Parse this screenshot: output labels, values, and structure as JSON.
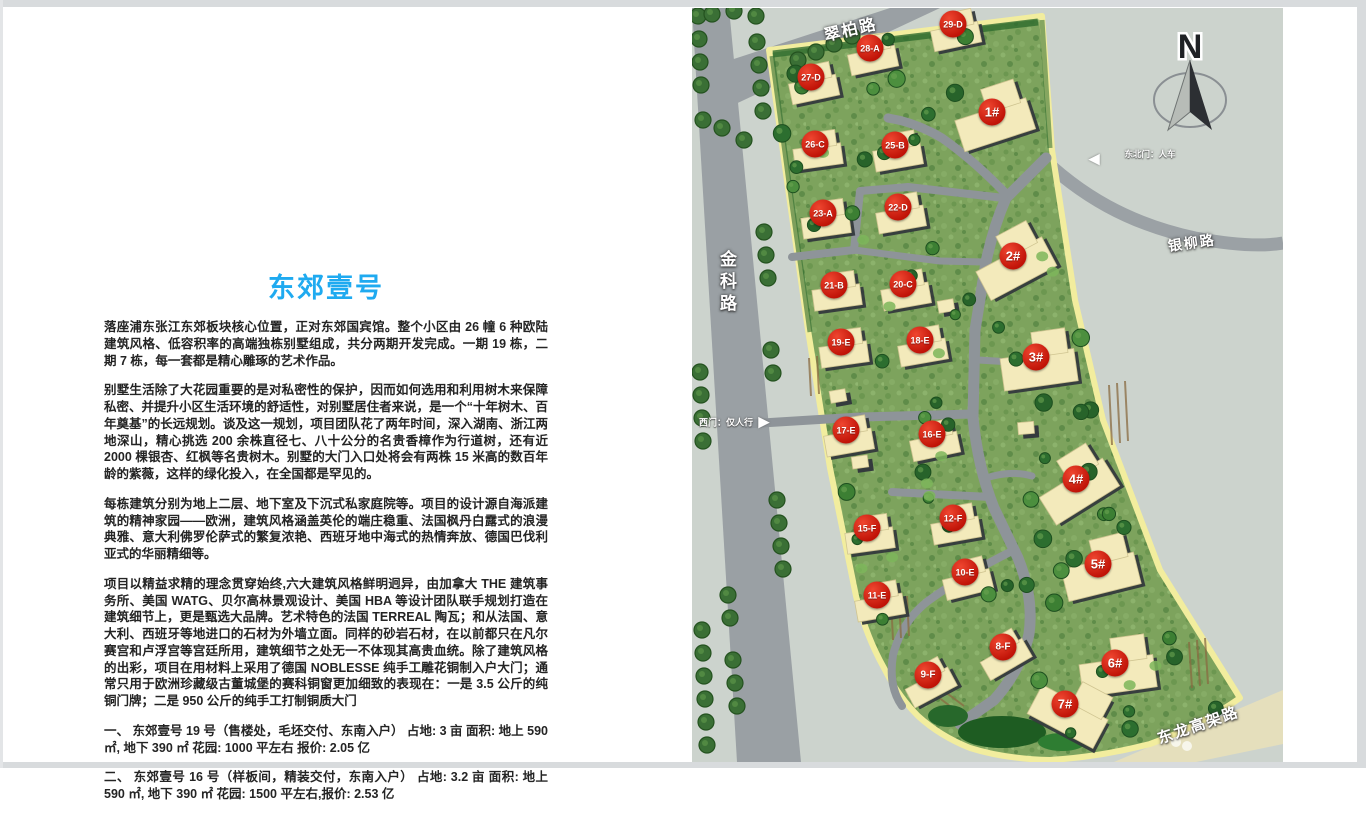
{
  "doc": {
    "title": "东郊壹号",
    "title_color": "#1faaf0",
    "paragraphs": [
      "落座浦东张江东郊板块核心位置，正对东郊国宾馆。整个小区由 26 幢 6 种欧陆建筑风格、低容积率的高端独栋别墅组成，共分两期开发完成。一期 19 栋，二期 7 栋，每一套都是精心雕琢的艺术作品。",
      "别墅生活除了大花园重要的是对私密性的保护，因而如何选用和利用树木来保障私密、并提升小区生活环境的舒适性，对别墅居住者来说，是一个“十年树木、百年奠基”的长远规划。谈及这一规划，项目团队花了两年时间，深入湖南、浙江两地深山，精心挑选 200 余株直径七、八十公分的名贵香樟作为行道树，还有近 2000 棵银杏、红枫等名贵树木。别墅的大门入口处将会有两株 15 米高的数百年龄的紫薇，这样的绿化投入，在全国都是罕见的。",
      "每栋建筑分别为地上二层、地下室及下沉式私家庭院等。项目的设计源自海派建筑的精神家园——欧洲，建筑风格涵盖英伦的端庄稳重、法国枫丹白露式的浪漫典雅、意大利佛罗伦萨式的繁复浓艳、西班牙地中海式的热情奔放、德国巴伐利亚式的华丽精细等。",
      "项目以精益求精的理念贯穿始终,六大建筑风格鲜明迥异，由加拿大 THE 建筑事务所、美国 WATG、贝尔高林景观设计、美国 HBA 等设计团队联手规划打造在建筑细节上，更是甄选大品牌。艺术特色的法国 TERREAL 陶瓦；和从法国、意大利、西班牙等地进口的石材为外墙立面。同样的砂岩石材，在以前都只在凡尔赛宫和卢浮宫等宫廷所用，建筑细节之处无一不体现其高贵血统。除了建筑风格的出彩，项目在用材料上采用了德国 NOBLESSE 纯手工雕花铜制入户大门；通常只用于欧洲珍藏级古董城堡的赛科铜窗更加细致的表现在：一是 3.5 公斤的纯铜门牌；二是 950 公斤的纯手工打制铜质大门"
    ],
    "items": [
      "一、 东郊壹号 19 号（售楼处，毛坯交付、东南入户） 占地: 3 亩 面积: 地上 590 ㎡, 地下 390 ㎡ 花园: 1000 平左右 报价: 2.05 亿",
      "二、 东郊壹号 16 号（样板间，精装交付，东南入户） 占地: 3.2 亩 面积: 地上 590 ㎡, 地下 390 ㎡ 花园: 1500 平左右,报价: 2.53 亿"
    ]
  },
  "map": {
    "compass": "N",
    "marker_color": "#c8170b",
    "parcel_border_color": "#f2ed9e",
    "roads": [
      {
        "name": "cuibai-road",
        "label": "翠柏路",
        "x": 824,
        "y": 22,
        "rot": -13,
        "size": 16
      },
      {
        "name": "jinke-road",
        "label": "金科路",
        "x": 714,
        "y": 250,
        "rot": 0,
        "size": 17,
        "vertical": true
      },
      {
        "name": "yinliu-road",
        "label": "银柳路",
        "x": 1168,
        "y": 236,
        "rot": -8,
        "size": 14
      },
      {
        "name": "donglong-road",
        "label": "东龙高架路",
        "x": 1158,
        "y": 728,
        "rot": -19,
        "size": 15
      }
    ],
    "gates": [
      {
        "name": "northeast-gate",
        "label": "东北门：人车",
        "tx": 1150,
        "ty": 154,
        "arrow": "◀",
        "ax": 1094,
        "ay": 159,
        "fs": 8.5,
        "as": 15
      },
      {
        "name": "west-gate",
        "label": "西门：仅人行",
        "tx": 726,
        "ty": 422,
        "arrow": "▶",
        "ax": 764,
        "ay": 422,
        "fs": 9,
        "as": 15
      }
    ],
    "markers": [
      {
        "label": "1#",
        "x": 992,
        "y": 112,
        "big": 1,
        "rot": -18
      },
      {
        "label": "2#",
        "x": 1013,
        "y": 256,
        "big": 1,
        "rot": -28
      },
      {
        "label": "3#",
        "x": 1036,
        "y": 357,
        "big": 1,
        "rot": -8
      },
      {
        "label": "4#",
        "x": 1076,
        "y": 479,
        "big": 1,
        "rot": -32
      },
      {
        "label": "5#",
        "x": 1098,
        "y": 564,
        "big": 1,
        "rot": -14
      },
      {
        "label": "6#",
        "x": 1115,
        "y": 663,
        "big": 1,
        "rot": -8
      },
      {
        "label": "7#",
        "x": 1065,
        "y": 704,
        "big": 1,
        "rot": 28
      },
      {
        "label": "8-F",
        "x": 1003,
        "y": 647,
        "rot": -30
      },
      {
        "label": "9-F",
        "x": 928,
        "y": 675,
        "rot": -28
      },
      {
        "label": "10-E",
        "x": 965,
        "y": 572,
        "rot": -14
      },
      {
        "label": "11-E",
        "x": 877,
        "y": 595,
        "rot": -10
      },
      {
        "label": "12-F",
        "x": 953,
        "y": 518,
        "rot": -10
      },
      {
        "label": "15-F",
        "x": 867,
        "y": 528,
        "rot": -8
      },
      {
        "label": "16-E",
        "x": 932,
        "y": 434,
        "rot": -12
      },
      {
        "label": "17-E",
        "x": 846,
        "y": 430,
        "rot": -10
      },
      {
        "label": "18-E",
        "x": 920,
        "y": 340,
        "rot": -10
      },
      {
        "label": "19-E",
        "x": 841,
        "y": 342,
        "rot": -8
      },
      {
        "label": "20-C",
        "x": 903,
        "y": 284,
        "rot": -10
      },
      {
        "label": "21-B",
        "x": 834,
        "y": 285,
        "rot": -8
      },
      {
        "label": "22-D",
        "x": 898,
        "y": 207,
        "rot": -10
      },
      {
        "label": "23-A",
        "x": 823,
        "y": 213,
        "rot": -8
      },
      {
        "label": "25-B",
        "x": 895,
        "y": 145,
        "rot": -10
      },
      {
        "label": "26-C",
        "x": 815,
        "y": 144,
        "rot": -8
      },
      {
        "label": "27-D",
        "x": 811,
        "y": 77,
        "rot": -12
      },
      {
        "label": "28-A",
        "x": 870,
        "y": 48,
        "rot": -12
      },
      {
        "label": "29-D",
        "x": 953,
        "y": 24,
        "rot": -12
      }
    ]
  }
}
